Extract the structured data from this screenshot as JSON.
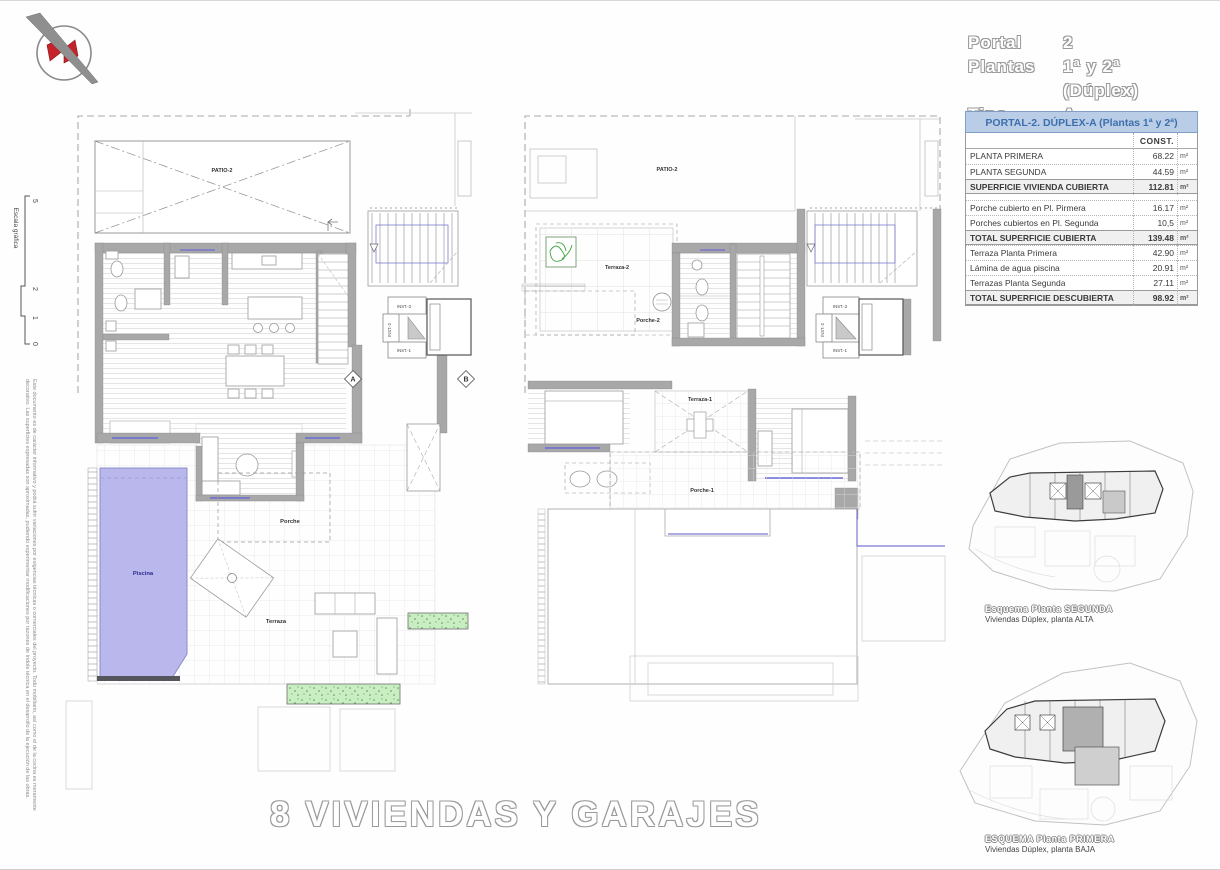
{
  "header": {
    "rows": [
      {
        "label": "Portal",
        "value": "2"
      },
      {
        "label": "Plantas",
        "value": "1ª y 2ª (Dúplex)"
      },
      {
        "label": "Tipo",
        "value": "A"
      }
    ]
  },
  "logo": {
    "name": "architect-logo"
  },
  "scale_bar": {
    "label": "Escala gráfica",
    "ticks": [
      "5",
      "2",
      "1",
      "0"
    ]
  },
  "disclaimer": {
    "line1": "Este documento es de carácter informativo y podrá sufrir variaciones por exigencias técnicas o comerciales del proyecto. Todo mobiliario, así como el de la cocina es meramente",
    "line2": "decorativo. Las superficies expresadas son aproximadas, pudiendo experimentar modificaciones por razones de índole técnica en el desarrollo de la ejecución de las obras."
  },
  "table": {
    "title": "PORTAL-2. DÚPLEX-A (Plantas 1ª y 2ª)",
    "col_header": "CONST.",
    "unit": "m²",
    "rows": [
      {
        "label": "PLANTA PRIMERA",
        "value": "68.22",
        "bold": false
      },
      {
        "label": "PLANTA SEGUNDA",
        "value": "44.59",
        "bold": false
      },
      {
        "label": "SUPERFICIE VIVIENDA CUBIERTA",
        "value": "112.81",
        "bold": true
      },
      {
        "label": "Porche cubierto en Pl. Pirmera",
        "value": "16.17",
        "bold": false,
        "gap_before": true
      },
      {
        "label": "Porches cubiertos en Pl. Segunda",
        "value": "10,5",
        "bold": false
      },
      {
        "label": "TOTAL SUPERFICIE CUBIERTA",
        "value": "139.48",
        "bold": true
      },
      {
        "label": "Terraza Planta Primera",
        "value": "42.90",
        "bold": false
      },
      {
        "label": "Lámina de agua piscina",
        "value": "20.91",
        "bold": false
      },
      {
        "label": "Terrazas Planta Segunda",
        "value": "27.11",
        "bold": false
      },
      {
        "label": "TOTAL SUPERFICIE DESCUBIERTA",
        "value": "98.92",
        "bold": true
      }
    ]
  },
  "plans": {
    "left": {
      "labels": {
        "patio": "PATIO-2",
        "porche": "Porche",
        "terraza": "Terraza",
        "piscina": "Piscina",
        "unit_number": "2",
        "marker_a": "A",
        "marker_b": "B",
        "inst1": "INST.-1",
        "inst2": "INST.-2",
        "inst3": "INST.-3"
      }
    },
    "right": {
      "labels": {
        "patio": "PATIO-2",
        "terraza2": "Terraza-2",
        "porche2": "Porche-2",
        "terraza1": "Terraza-1",
        "porche1": "Porche-1",
        "unit_number": "2",
        "inst1": "INST.-1",
        "inst2": "INST.-2",
        "inst3": "INST.-3"
      }
    }
  },
  "site_plans": [
    {
      "caption": "Esquema Planta SEGUNDA",
      "subcaption": "Viviendas Dúplex, planta ALTA"
    },
    {
      "caption": "ESQUEMA Planta PRIMERA",
      "subcaption": "Viviendas Dúplex, planta BAJA"
    }
  ],
  "footer": {
    "title": "8 VIVIENDAS Y GARAJES"
  },
  "colors": {
    "pool": "#b9b7ec",
    "pool_label": "#2b2b8c",
    "wall": "#a8a8a8",
    "planter_green": "#c8eec2",
    "window_blue": "#6b6bd6",
    "table_header_bg": "#b9cde6",
    "table_header_text": "#3e6fad"
  }
}
